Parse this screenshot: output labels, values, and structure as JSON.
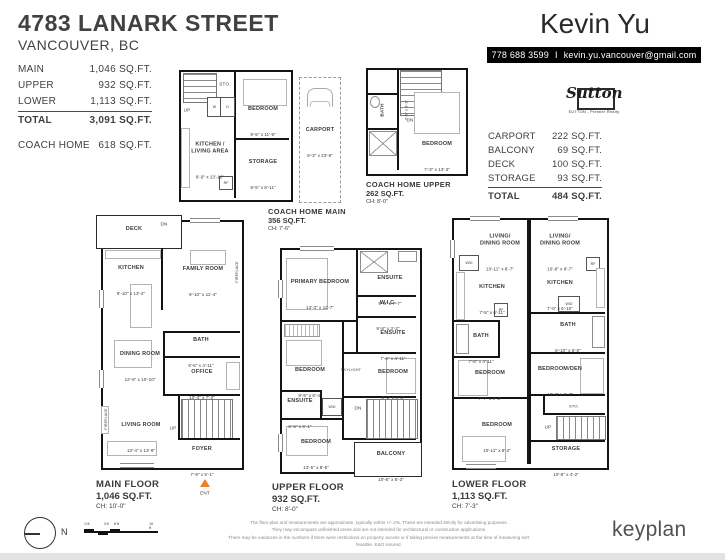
{
  "colors": {
    "accent_orange": "#ef8022",
    "contact_bar": "#000000",
    "text_dark": "#3f3f41"
  },
  "header": {
    "address": "4783 LANARK STREET",
    "city": "VANCOUVER, BC",
    "agent": "Kevin Yu",
    "phone": "778 688 3599",
    "separator": "I",
    "email": "kevin.yu.vancouver@gmail.com",
    "brand": "Sutton",
    "brand_tagline": "SUTTON - Premier Realty"
  },
  "summary_left": {
    "rows": [
      {
        "label": "MAIN",
        "value": "1,046 SQ.FT."
      },
      {
        "label": "UPPER",
        "value": "932 SQ.FT."
      },
      {
        "label": "LOWER",
        "value": "1,113 SQ.FT."
      }
    ],
    "total": {
      "label": "TOTAL",
      "value": "3,091 SQ.FT."
    },
    "coach": {
      "label": "COACH HOME",
      "value": "618 SQ.FT."
    }
  },
  "summary_right": {
    "rows": [
      {
        "label": "CARPORT",
        "value": "222 SQ.FT."
      },
      {
        "label": "BALCONY",
        "value": "69 SQ.FT."
      },
      {
        "label": "DECK",
        "value": "100 SQ.FT."
      },
      {
        "label": "STORAGE",
        "value": "93 SQ.FT."
      }
    ],
    "total": {
      "label": "TOTAL",
      "value": "484 SQ.FT."
    }
  },
  "plans": {
    "coach_main": {
      "title": "COACH HOME MAIN",
      "area": "356 SQ.FT.",
      "ceiling": "CH: 7'-6\"",
      "rooms": {
        "bedroom": {
          "name": "BEDROOM",
          "dims": "9'-5\" x 11'-9\""
        },
        "kitchen_living": {
          "name": "KITCHEN /\nLIVING AREA",
          "dims": "8'-9\" x 13'-10\""
        },
        "storage": {
          "name": "STORAGE",
          "dims": "9'-5\" x 8'-11\""
        },
        "carport": {
          "name": "CARPORT",
          "dims": "9'-3\" x 23'-9\""
        }
      },
      "ann": {
        "sto": "STO.",
        "up": "UP",
        "w": "W",
        "d": "D",
        "rf": "RF"
      }
    },
    "coach_upper": {
      "title": "COACH HOME UPPER",
      "area": "262 SQ.FT.",
      "ceiling": "CH: 8'-0\"",
      "rooms": {
        "bedroom": {
          "name": "BEDROOM",
          "dims": "7'-3\" x 13'-3\""
        },
        "bath": {
          "name": "BATH",
          "dims": "7'-9\" x 3'-1\""
        }
      },
      "ann": {
        "dn": "DN"
      }
    },
    "main": {
      "title": "MAIN FLOOR",
      "area": "1,046 SQ.FT.",
      "ceiling": "CH: 10'-0\"",
      "rooms": {
        "deck": {
          "name": "DECK",
          "dims": "14'-0\" x 5'-5\""
        },
        "kitchen": {
          "name": "KITCHEN",
          "dims": "8'-10\" x 13'-2\""
        },
        "family": {
          "name": "FAMILY ROOM",
          "dims": "9'-10\" x 11'-4\""
        },
        "bath": {
          "name": "BATH",
          "dims": "6'-6\" x 4'-11\""
        },
        "dining": {
          "name": "DINING ROOM",
          "dims": "12'-6\" x 10'-10\""
        },
        "office": {
          "name": "OFFICE",
          "dims": "10'-3\" x 7'-3\""
        },
        "living": {
          "name": "LIVING ROOM",
          "dims": "13'-4\" x 13'-9\""
        },
        "foyer": {
          "name": "FOYER",
          "dims": "7'-9\" x 5'-1\""
        }
      },
      "ann": {
        "dn": "DN",
        "up": "UP",
        "fireplace": "FIREPLACE",
        "ent": "ENT"
      }
    },
    "upper": {
      "title": "UPPER FLOOR",
      "area": "932 SQ.FT.",
      "ceiling": "CH: 8'-0\"",
      "rooms": {
        "primary": {
          "name": "PRIMARY BEDROOM",
          "dims": "13'-3\" x 11'-7\""
        },
        "ensuite1": {
          "name": "ENSUITE",
          "dims": "9'-8\" x 7'-7\""
        },
        "wic": {
          "name": "W.I.C.",
          "dims": "9'-8\" x 3'-2\""
        },
        "ensuite2": {
          "name": "ENSUITE",
          "dims": "7'-6\" x 4'-11\""
        },
        "bedroom2": {
          "name": "BEDROOM",
          "dims": "9'-5\" x 8'-4\""
        },
        "bedroom3": {
          "name": "BEDROOM",
          "dims": "8'-1\" x 8'-3\""
        },
        "ensuite3": {
          "name": "ENSUITE",
          "dims": "6'-5\" x 6'-1\""
        },
        "bedroom4": {
          "name": "BEDROOM",
          "dims": "13'-5\" x 8'-5\""
        },
        "balcony": {
          "name": "BALCONY",
          "dims": "10'-6\" x 6'-3\""
        }
      },
      "ann": {
        "skylight": "SKYLIGHT",
        "wd": "W/D",
        "dn": "DN"
      }
    },
    "lower": {
      "title": "LOWER FLOOR",
      "area": "1,113 SQ.FT.",
      "ceiling": "CH: 7'-3\"",
      "rooms": {
        "living1": {
          "name": "LIVING/\nDINING ROOM",
          "dims": "10'-11\" x 8'-7\""
        },
        "kitchen1": {
          "name": "KITCHEN",
          "dims": "7'-5\" x 6'-11\""
        },
        "bath1": {
          "name": "BATH",
          "dims": "7'-8\" x 4'-11\""
        },
        "bedroom1": {
          "name": "BEDROOM",
          "dims": "7'-7\" x 9'-3\""
        },
        "bedroom2": {
          "name": "BEDROOM",
          "dims": "10'-11\" x 8'-2\""
        },
        "living2": {
          "name": "LIVING/\nDINING ROOM",
          "dims": "10'-8\" x 8'-7\""
        },
        "kitchen2": {
          "name": "KITCHEN",
          "dims": "7'-0\" x 6'-10\""
        },
        "bath2": {
          "name": "BATH",
          "dims": "6'-10\" x 5'-0\""
        },
        "bedroom_den": {
          "name": "BEDROOM/DEN",
          "dims": "10'-8\" x 9'-7\""
        },
        "storage": {
          "name": "STORAGE",
          "dims": "10'-8\" x 4'-2\""
        }
      },
      "ann": {
        "wd": "W/D",
        "rf": "RF",
        "sto": "STO.",
        "up": "UP"
      }
    }
  },
  "footer": {
    "compass_n": "N",
    "scale_ticks": [
      "0 ft",
      "3 ft",
      "6 ft",
      "10 ft"
    ],
    "disclaimer_line1": "The floor plan and measurements are approximate, typically within +/- 2%. These are intended strictly for advertising purposes.",
    "disclaimer_line2": "They may encompass unfinished areas and are not intended for architectural or construction applications.",
    "disclaimer_line3": "There may be variances in the numbers if there were restrictions on property access or if taking precise measurements at the time of measuring isn't feasible. E&O insured.",
    "logo": "keyplan"
  }
}
